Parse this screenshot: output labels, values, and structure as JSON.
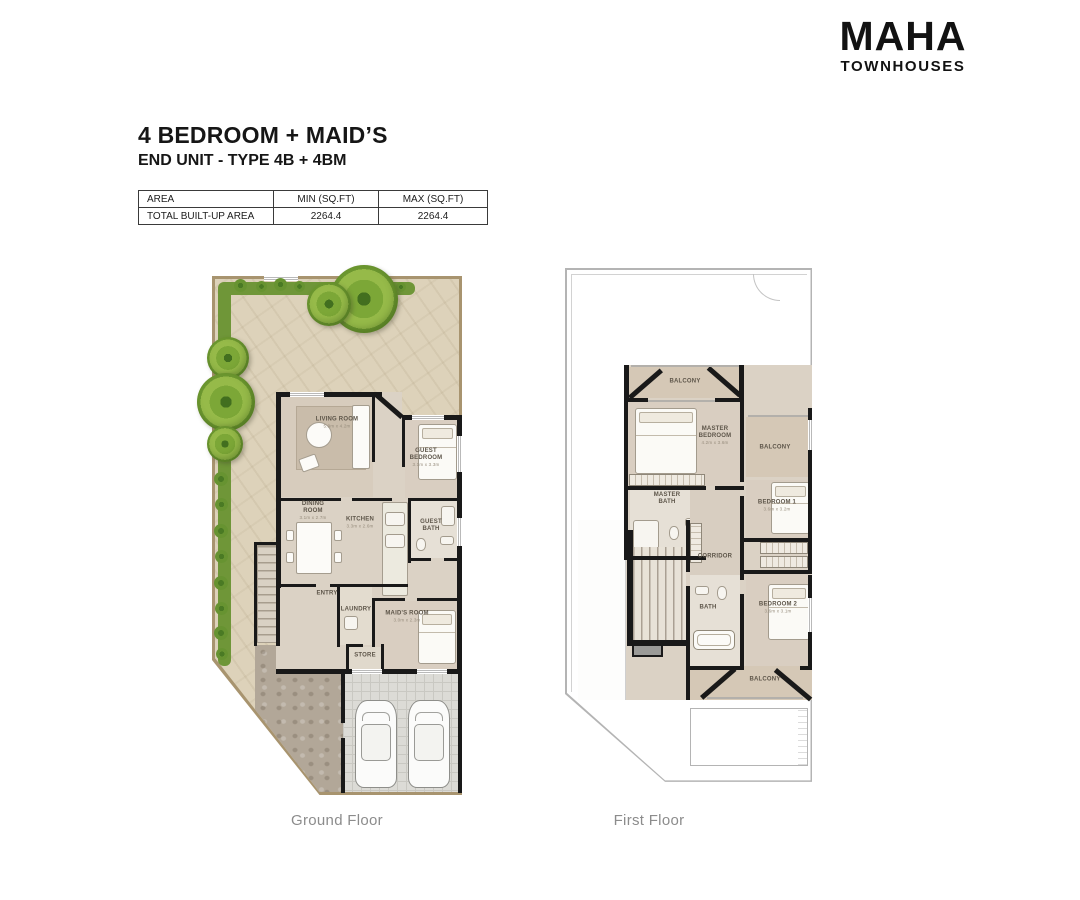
{
  "logo": {
    "name": "MAHA",
    "tagline": "TOWNHOUSES"
  },
  "title": {
    "main": "4 BEDROOM + MAID’S",
    "sub": "END UNIT - TYPE 4B + 4BM"
  },
  "area_table": {
    "headers": [
      "AREA",
      "MIN (SQ.FT)",
      "MAX (SQ.FT)"
    ],
    "row": {
      "label": "TOTAL BUILT-UP AREA",
      "min": "2264.4",
      "max": "2264.4"
    }
  },
  "floors": {
    "ground": {
      "caption": "Ground Floor",
      "rooms": [
        {
          "label": "LIVING ROOM",
          "dims": "5.9m x 4.2m"
        },
        {
          "label": "GUEST BEDROOM",
          "dims": "3.1m x 3.3m"
        },
        {
          "label": "DINING ROOM",
          "dims": "3.1m x 2.7m"
        },
        {
          "label": "KITCHEN",
          "dims": "3.3m x 2.6m"
        },
        {
          "label": "GUEST BATH",
          "dims": ""
        },
        {
          "label": "ENTRY",
          "dims": ""
        },
        {
          "label": "LAUNDRY",
          "dims": ""
        },
        {
          "label": "MAID'S ROOM",
          "dims": "3.0m x 2.3m"
        },
        {
          "label": "STORE",
          "dims": ""
        }
      ]
    },
    "first": {
      "caption": "First Floor",
      "rooms": [
        {
          "label": "BALCONY",
          "dims": ""
        },
        {
          "label": "MASTER BEDROOM",
          "dims": "4.2m x 3.6m"
        },
        {
          "label": "MASTER BATH",
          "dims": ""
        },
        {
          "label": "BALCONY",
          "dims": ""
        },
        {
          "label": "BEDROOM 1",
          "dims": "3.6m x 3.2m"
        },
        {
          "label": "CORRIDOR",
          "dims": ""
        },
        {
          "label": "BATH",
          "dims": ""
        },
        {
          "label": "BEDROOM 2",
          "dims": "3.6m x 3.1m"
        },
        {
          "label": "BALCONY",
          "dims": ""
        }
      ]
    }
  },
  "colors": {
    "wall": "#191919",
    "floor": "#d9cec1",
    "garden": "#ddd2ba",
    "boundary": "#a8946f",
    "hedge": "#6f9638",
    "tree": "#7ca737",
    "tiles": "#dcdbd6",
    "patio": "#b2a798",
    "roof_outline": "#b4b4b4",
    "caption_text": "#8c8c8c"
  }
}
